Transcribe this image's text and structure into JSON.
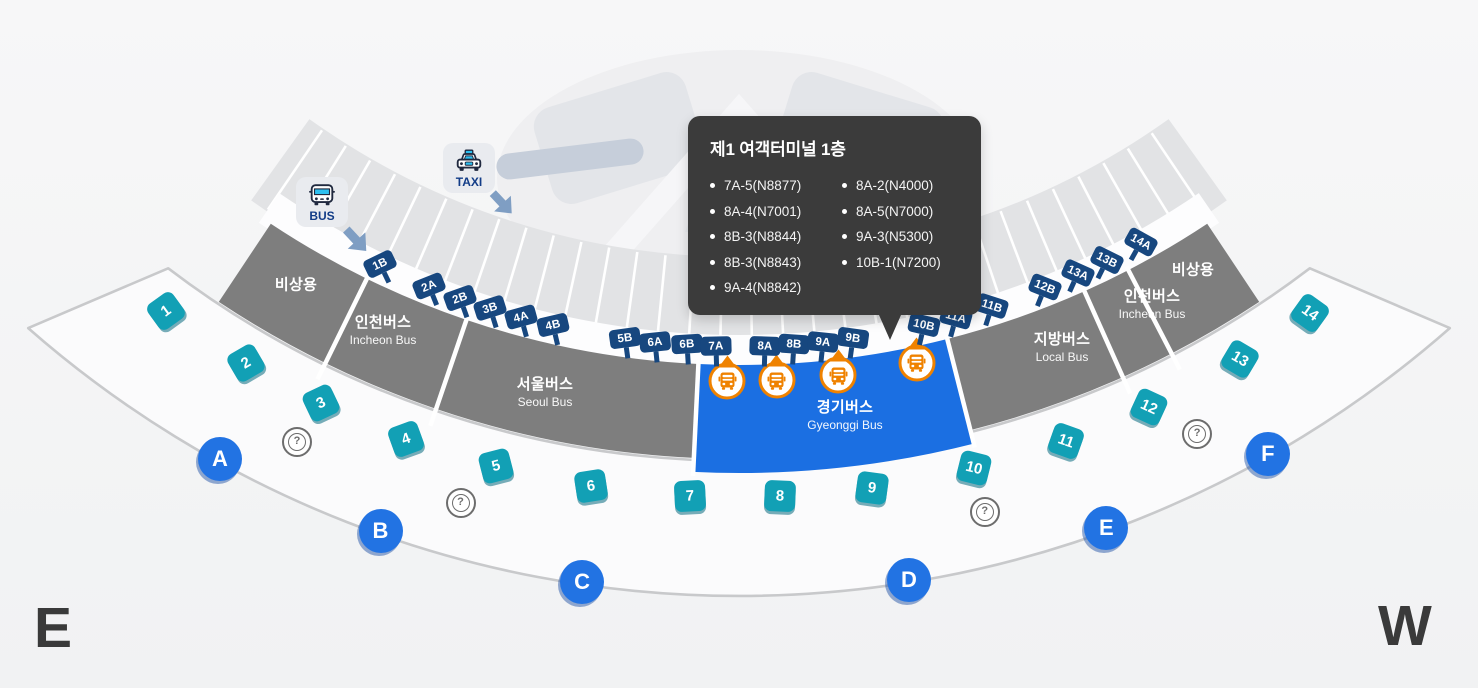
{
  "tooltip": {
    "title": "제1 여객터미널 1층",
    "items_col1": [
      "7A-5(N8877)",
      "8A-4(N7001)",
      "8B-3(N8844)",
      "8B-3(N8843)",
      "9A-4(N8842)"
    ],
    "items_col2": [
      "8A-2(N4000)",
      "8A-5(N7000)",
      "9A-3(N5300)",
      "10B-1(N7200)"
    ]
  },
  "transport": {
    "bus_label": "BUS",
    "taxi_label": "TAXI"
  },
  "zones": [
    {
      "name_kr": "비상용",
      "name_en": ""
    },
    {
      "name_kr": "인천버스",
      "name_en": "Incheon Bus"
    },
    {
      "name_kr": "서울버스",
      "name_en": "Seoul Bus"
    },
    {
      "name_kr": "경기버스",
      "name_en": "Gyeonggi Bus",
      "highlighted": true
    },
    {
      "name_kr": "지방버스",
      "name_en": "Local Bus"
    },
    {
      "name_kr": "인천버스",
      "name_en": "Incheon Bus"
    },
    {
      "name_kr": "비상용",
      "name_en": ""
    }
  ],
  "gates": [
    "1B",
    "2A",
    "2B",
    "3B",
    "4A",
    "4B",
    "5B",
    "6A",
    "6B",
    "7A",
    "8A",
    "8B",
    "9A",
    "9B",
    "10B",
    "11A",
    "11B",
    "12B",
    "13A",
    "13B",
    "14A"
  ],
  "stop_numbers": [
    "1",
    "2",
    "3",
    "4",
    "5",
    "6",
    "7",
    "8",
    "9",
    "10",
    "11",
    "12",
    "13",
    "14"
  ],
  "exit_letters": [
    "A",
    "B",
    "C",
    "D",
    "E",
    "F"
  ],
  "help": {
    "symbol": "?",
    "count": 4
  },
  "bus_markers": {
    "count": 4
  },
  "compass": {
    "east": "E",
    "west": "W"
  },
  "colors": {
    "zone_gray": "#7e7e7e",
    "zone_highlight": "#1b6fe2",
    "gate_navy": "#17477f",
    "stop_teal": "#12a0b5",
    "exit_blue": "#2273e3",
    "marker_orange": "#ef8200",
    "tooltip_bg": "#3b3b3b"
  }
}
